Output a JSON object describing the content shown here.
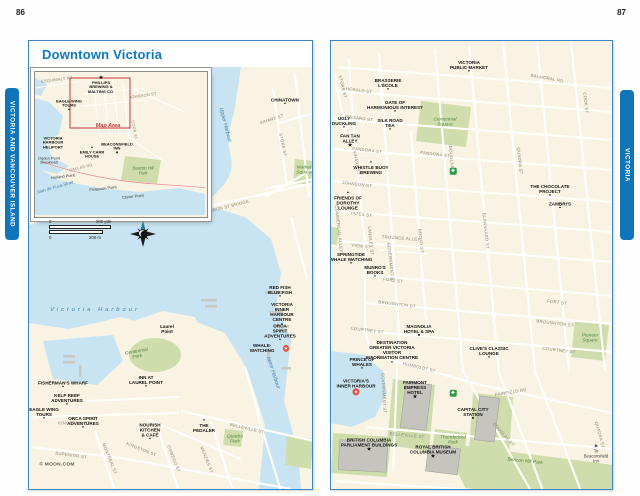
{
  "page": {
    "left_number": "86",
    "right_number": "87",
    "left_tab": "VICTORIA AND VANCOUVER ISLAND",
    "right_tab": "VICTORIA",
    "title": "Downtown Victoria"
  },
  "colors": {
    "frame_blue": "#3c85c4",
    "tab_blue": "#1074b9",
    "title_blue": "#0d79bf",
    "land": "#f8f3e2",
    "water": "#c8e3f1",
    "park": "#cfddad",
    "activity_red": "#e04f39",
    "icon_green": "#35984b"
  },
  "icon_glyphs": {
    "dot": "●",
    "square": "■",
    "star": "★",
    "activity": "✶",
    "ginfo": "✚",
    "arrow": "➤"
  },
  "scale_bar": {
    "zero": "0",
    "yds": "200 yds",
    "zero2": "0",
    "m": "200 m"
  },
  "left_map": {
    "labels": [
      {
        "text": "CHINATOWN",
        "x": 256,
        "y": 35,
        "cls": "poi",
        "marker": "dot"
      },
      {
        "text": "WHARF ST",
        "x": 243,
        "y": 53,
        "cls": "street",
        "rot": -18
      },
      {
        "text": "STORE ST",
        "x": 253,
        "y": 78,
        "cls": "street",
        "rot": 78
      },
      {
        "text": "Market Square",
        "x": 275,
        "y": 104,
        "cls": "park"
      },
      {
        "text": "Upper Harbour",
        "x": 196,
        "y": 58,
        "cls": "water",
        "rot": 75
      },
      {
        "text": "JOHNSON ST BRIDGE",
        "x": 196,
        "y": 141,
        "cls": "street",
        "rot": -14
      },
      {
        "text": "Victoria Harbour",
        "x": 66,
        "y": 243,
        "cls": "water sp"
      },
      {
        "text": "Inner Harbour",
        "x": 244,
        "y": 306,
        "cls": "water",
        "rot": 72
      },
      {
        "text": "Laurel\nPoint",
        "x": 138,
        "y": 262,
        "cls": "poi"
      },
      {
        "text": "Centennial\nPark",
        "x": 108,
        "y": 288,
        "cls": "park",
        "rot": -10
      },
      {
        "text": "RED FISH\nBLUE FISH",
        "x": 251,
        "y": 225,
        "cls": "poi",
        "marker": "dot"
      },
      {
        "text": "VICTORIA\nINNER HARBOUR\nCENTRE",
        "x": 253,
        "y": 247,
        "cls": "poi",
        "marker": "dot"
      },
      {
        "text": "ORCA\nSPIRIT ADVENTURES",
        "x": 251,
        "y": 266,
        "cls": "poi",
        "marker": "dot"
      },
      {
        "text": "WHALE-WATCHING",
        "x": 237,
        "y": 281,
        "cls": "poi",
        "marker": "activity",
        "mpos": "right"
      },
      {
        "text": "INN AT\nLAUREL POINT",
        "x": 117,
        "y": 315,
        "cls": "poi",
        "marker": "dot"
      },
      {
        "text": "FISHERMAN'S WHARF",
        "x": 34,
        "y": 318,
        "cls": "poi",
        "marker": "dot"
      },
      {
        "text": "KELP REEF\nADVENTURES",
        "x": 38,
        "y": 333,
        "cls": "poi",
        "marker": "dot"
      },
      {
        "text": "EAGLE WING\nTOURS",
        "x": 15,
        "y": 347,
        "cls": "poi",
        "marker": "dot"
      },
      {
        "text": "ORCA SPIRIT\nADVENTURES",
        "x": 54,
        "y": 356,
        "cls": "poi",
        "marker": "dot"
      },
      {
        "text": "NOURISH\nKITCHEN\n& CAFÉ",
        "x": 121,
        "y": 365,
        "cls": "poi",
        "marker": "dot"
      },
      {
        "text": "THE\nPEDALER",
        "x": 175,
        "y": 359,
        "cls": "poi",
        "marker": "dot",
        "mpos": "top"
      },
      {
        "text": "Quadra\nPark",
        "x": 206,
        "y": 373,
        "cls": "park"
      },
      {
        "text": "KINGSTON ST",
        "x": 45,
        "y": 357,
        "cls": "street"
      },
      {
        "text": "SUPERIOR ST",
        "x": 42,
        "y": 389,
        "cls": "street",
        "rot": 8
      },
      {
        "text": "MONTREAL ST",
        "x": 80,
        "y": 392,
        "cls": "street",
        "rot": 68
      },
      {
        "text": "KINGSTON ST",
        "x": 112,
        "y": 383,
        "cls": "street",
        "rot": 22
      },
      {
        "text": "OSWEGO ST",
        "x": 144,
        "y": 392,
        "cls": "street",
        "rot": 68
      },
      {
        "text": "MENZIES ST",
        "x": 177,
        "y": 393,
        "cls": "street",
        "rot": 68
      },
      {
        "text": "BELLEVILLE ST",
        "x": 218,
        "y": 362,
        "cls": "street",
        "rot": 13
      },
      {
        "text": "© MOON.COM",
        "x": 28,
        "y": 398,
        "cls": "credit"
      }
    ]
  },
  "inset": {
    "labels": [
      {
        "text": "ESQUIMALT RD",
        "x": 22,
        "y": 8,
        "cls": "street",
        "rot": -7
      },
      {
        "text": "PHILLIPS\nBREWING &\nMALTING CO.",
        "x": 66,
        "y": 13,
        "cls": "poi",
        "marker": "star",
        "mpos": "top"
      },
      {
        "text": "JOHNSON ST",
        "x": 108,
        "y": 24,
        "cls": "street",
        "rot": -8
      },
      {
        "text": "EAGLE WING\nTOURS",
        "x": 34,
        "y": 34,
        "cls": "poi",
        "marker": "dot"
      },
      {
        "text": "Map Area",
        "x": 73,
        "y": 54,
        "cls": "redlbl"
      },
      {
        "text": "VICTORIA\nHARBOUR\nHELIPORT",
        "x": 18,
        "y": 71,
        "cls": "poi"
      },
      {
        "text": "COOK ST",
        "x": 99,
        "y": 58,
        "cls": "street",
        "rot": 80
      },
      {
        "text": "EMILY CARR\nHOUSE",
        "x": 57,
        "y": 81,
        "cls": "poi",
        "marker": "dot",
        "mpos": "top"
      },
      {
        "text": "BEACONSFIELD\nINN",
        "x": 82,
        "y": 77,
        "cls": "poi",
        "marker": "square"
      },
      {
        "text": "Beacon Hill\nPark",
        "x": 108,
        "y": 99,
        "cls": "park"
      },
      {
        "text": "Ogden Point\nBreakwall",
        "x": 14,
        "y": 89,
        "cls": "place"
      },
      {
        "text": "DALLAS RD",
        "x": 46,
        "y": 96,
        "cls": "street",
        "rot": -14
      },
      {
        "text": "Holland Point",
        "x": 28,
        "y": 105,
        "cls": "place",
        "rot": -7
      },
      {
        "text": "Juan de Fuca Strait",
        "x": 20,
        "y": 116,
        "cls": "water",
        "rot": -16
      },
      {
        "text": "Finlayson Point",
        "x": 68,
        "y": 117,
        "cls": "place",
        "rot": -6
      },
      {
        "text": "Clover Point",
        "x": 98,
        "y": 125,
        "cls": "place",
        "rot": -6
      }
    ]
  },
  "right_map": {
    "labels": [
      {
        "text": "VICTORIA\nPUBLIC MARKET",
        "x": 138,
        "y": 26,
        "cls": "poi",
        "marker": "dot"
      },
      {
        "text": "BALMORAL RD",
        "x": 216,
        "y": 38,
        "cls": "street",
        "rot": 10
      },
      {
        "text": "HERALD ST",
        "x": 28,
        "y": 50,
        "cls": "street",
        "rot": 7
      },
      {
        "text": "BRASSERIE\nL'ÉCOLE",
        "x": 57,
        "y": 44,
        "cls": "poi",
        "marker": "dot"
      },
      {
        "text": "GATE OF\nHARMONIOUS INTEREST",
        "x": 64,
        "y": 66,
        "cls": "poi",
        "marker": "dot"
      },
      {
        "text": "FISGARD ST",
        "x": 28,
        "y": 78,
        "cls": "street",
        "rot": 7
      },
      {
        "text": "UGLY\nDUCKLING",
        "x": 13,
        "y": 82,
        "cls": "poi",
        "marker": "dot"
      },
      {
        "text": "SILK ROAD\nTEA",
        "x": 59,
        "y": 84,
        "cls": "poi",
        "marker": "dot"
      },
      {
        "text": "FAN TAN\nALLEY",
        "x": 19,
        "y": 100,
        "cls": "poi",
        "marker": "star"
      },
      {
        "text": "PANDORA ST",
        "x": 36,
        "y": 110,
        "cls": "street",
        "rot": 7
      },
      {
        "text": "PANDORA ST",
        "x": 104,
        "y": 114,
        "cls": "street",
        "rot": 7
      },
      {
        "text": "WHISTLE BUOY\nBREWING",
        "x": 40,
        "y": 127,
        "cls": "poi",
        "marker": "dot",
        "mpos": "top"
      },
      {
        "text": "JOHNSON ST",
        "x": 26,
        "y": 144,
        "cls": "street",
        "rot": 7
      },
      {
        "text": "FRIENDS OF\nDOROTHY\nLOUNGE",
        "x": 17,
        "y": 160,
        "cls": "poi",
        "marker": "dot",
        "mpos": "top"
      },
      {
        "text": "THE CHOCOLATE\nPROJECT",
        "x": 219,
        "y": 150,
        "cls": "poi",
        "marker": "dot"
      },
      {
        "text": "ZAMBRI'S",
        "x": 229,
        "y": 165,
        "cls": "poi",
        "marker": "dot"
      },
      {
        "text": "YATES ST",
        "x": 30,
        "y": 174,
        "cls": "street",
        "rot": 7
      },
      {
        "text": "TROUNCE ALLEY",
        "x": 70,
        "y": 198,
        "cls": "street",
        "rot": 4
      },
      {
        "text": "VIEW ST",
        "x": 30,
        "y": 206,
        "cls": "street",
        "rot": 7
      },
      {
        "text": "SPRINGTIDE\nWHALE WATCHING",
        "x": 20,
        "y": 218,
        "cls": "poi",
        "marker": "dot"
      },
      {
        "text": "MUNRO'S\nBOOKS",
        "x": 44,
        "y": 231,
        "cls": "poi",
        "marker": "dot"
      },
      {
        "text": "FORT ST",
        "x": 62,
        "y": 240,
        "cls": "street",
        "rot": 7
      },
      {
        "text": "FORT ST",
        "x": 226,
        "y": 262,
        "cls": "street",
        "rot": 7
      },
      {
        "text": "BROUGHTON ST",
        "x": 66,
        "y": 264,
        "cls": "street",
        "rot": 7
      },
      {
        "text": "BROUGHTON ST",
        "x": 224,
        "y": 283,
        "cls": "street",
        "rot": 7
      },
      {
        "text": "COURTNEY ST",
        "x": 36,
        "y": 290,
        "cls": "street",
        "rot": 7
      },
      {
        "text": "COURTNEY ST",
        "x": 228,
        "y": 310,
        "cls": "street",
        "rot": 7
      },
      {
        "text": "MAGNOLIA\nHOTEL & SPA",
        "x": 88,
        "y": 290,
        "cls": "poi",
        "marker": "square"
      },
      {
        "text": "DESTINATION\nGREATER VICTORIA\nVISITOR\nINFORMATION CENTRE",
        "x": 61,
        "y": 311,
        "cls": "poi",
        "marker": "dot"
      },
      {
        "text": "CLIVE'S CLASSIC\nLOUNGE",
        "x": 158,
        "y": 312,
        "cls": "poi",
        "marker": "dot"
      },
      {
        "text": "PRINCE OF\nWHALES",
        "x": 31,
        "y": 323,
        "cls": "poi",
        "marker": "dot"
      },
      {
        "text": "HUMBOLDT ST",
        "x": 88,
        "y": 327,
        "cls": "street",
        "rot": 13
      },
      {
        "text": "Pioneer\nSquare",
        "x": 259,
        "y": 298,
        "cls": "park"
      },
      {
        "text": "VICTORIA'S\nINNER HARBOUR",
        "x": 25,
        "y": 346,
        "cls": "poi",
        "marker": "activity"
      },
      {
        "text": "FAIRMONT\nEMPRESS\nHOTEL",
        "x": 84,
        "y": 349,
        "cls": "poi",
        "marker": "star"
      },
      {
        "text": "FAIRFIELD RD",
        "x": 180,
        "y": 352,
        "cls": "street",
        "rot": -10
      },
      {
        "text": "CAPITAL CITY\nSTATION",
        "x": 142,
        "y": 373,
        "cls": "poi",
        "marker": "square"
      },
      {
        "text": "BELLEVILLE ST",
        "x": 76,
        "y": 395,
        "cls": "street",
        "rot": 5
      },
      {
        "text": "BRITISH COLUMBIA\nPARLIAMENT BUILDINGS",
        "x": 38,
        "y": 404,
        "cls": "poi",
        "marker": "star"
      },
      {
        "text": "ROYAL BRITISH\nCOLUMBIA MUSEUM",
        "x": 102,
        "y": 411,
        "cls": "poi",
        "marker": "star"
      },
      {
        "text": "Thunderbird\nPark",
        "x": 122,
        "y": 400,
        "cls": "park"
      },
      {
        "text": "Beacon Hill Park",
        "x": 194,
        "y": 421,
        "cls": "park",
        "rot": 6
      },
      {
        "text": "To\nBeaconsfield\nInn",
        "x": 265,
        "y": 413,
        "cls": "place",
        "marker": "arrow",
        "mpos": "top"
      },
      {
        "text": "Centennial\nSquare",
        "x": 114,
        "y": 82,
        "cls": "park"
      },
      {
        "text": "STORE ST",
        "x": 11,
        "y": 46,
        "cls": "street",
        "rot": 76
      },
      {
        "text": "WHARF ST",
        "x": 25,
        "y": 122,
        "cls": "street",
        "rot": 80
      },
      {
        "text": "COMMERCIAL\nALLEY",
        "x": 7,
        "y": 188,
        "cls": "street",
        "rot": 84
      },
      {
        "text": "LANGLEY ST",
        "x": 39,
        "y": 200,
        "cls": "street",
        "rot": 84
      },
      {
        "text": "GOVERNMENT ST",
        "x": 59,
        "y": 222,
        "cls": "street",
        "rot": 84
      },
      {
        "text": "BROAD ST",
        "x": 89,
        "y": 200,
        "cls": "street",
        "rot": 84
      },
      {
        "text": "DOUGLAS ST",
        "x": 120,
        "y": 120,
        "cls": "street",
        "rot": 84
      },
      {
        "text": "BLANSHARD ST",
        "x": 154,
        "y": 190,
        "cls": "street",
        "rot": 84
      },
      {
        "text": "QUADRA ST",
        "x": 188,
        "y": 120,
        "cls": "street",
        "rot": 84
      },
      {
        "text": "COOK ST",
        "x": 254,
        "y": 62,
        "cls": "street",
        "rot": 84
      },
      {
        "text": "GOVERNMENT ST",
        "x": 52,
        "y": 352,
        "cls": "street",
        "rot": 87
      },
      {
        "text": "DOUGLAS ST",
        "x": 172,
        "y": 394,
        "cls": "street",
        "rot": 48
      },
      {
        "text": "QUADRA ST",
        "x": 268,
        "y": 394,
        "cls": "street",
        "rot": 75
      },
      {
        "marker": "ginfo",
        "x": 122,
        "y": 130,
        "cls": "gicon"
      },
      {
        "marker": "ginfo",
        "x": 122,
        "y": 352,
        "cls": "gicon"
      }
    ]
  }
}
